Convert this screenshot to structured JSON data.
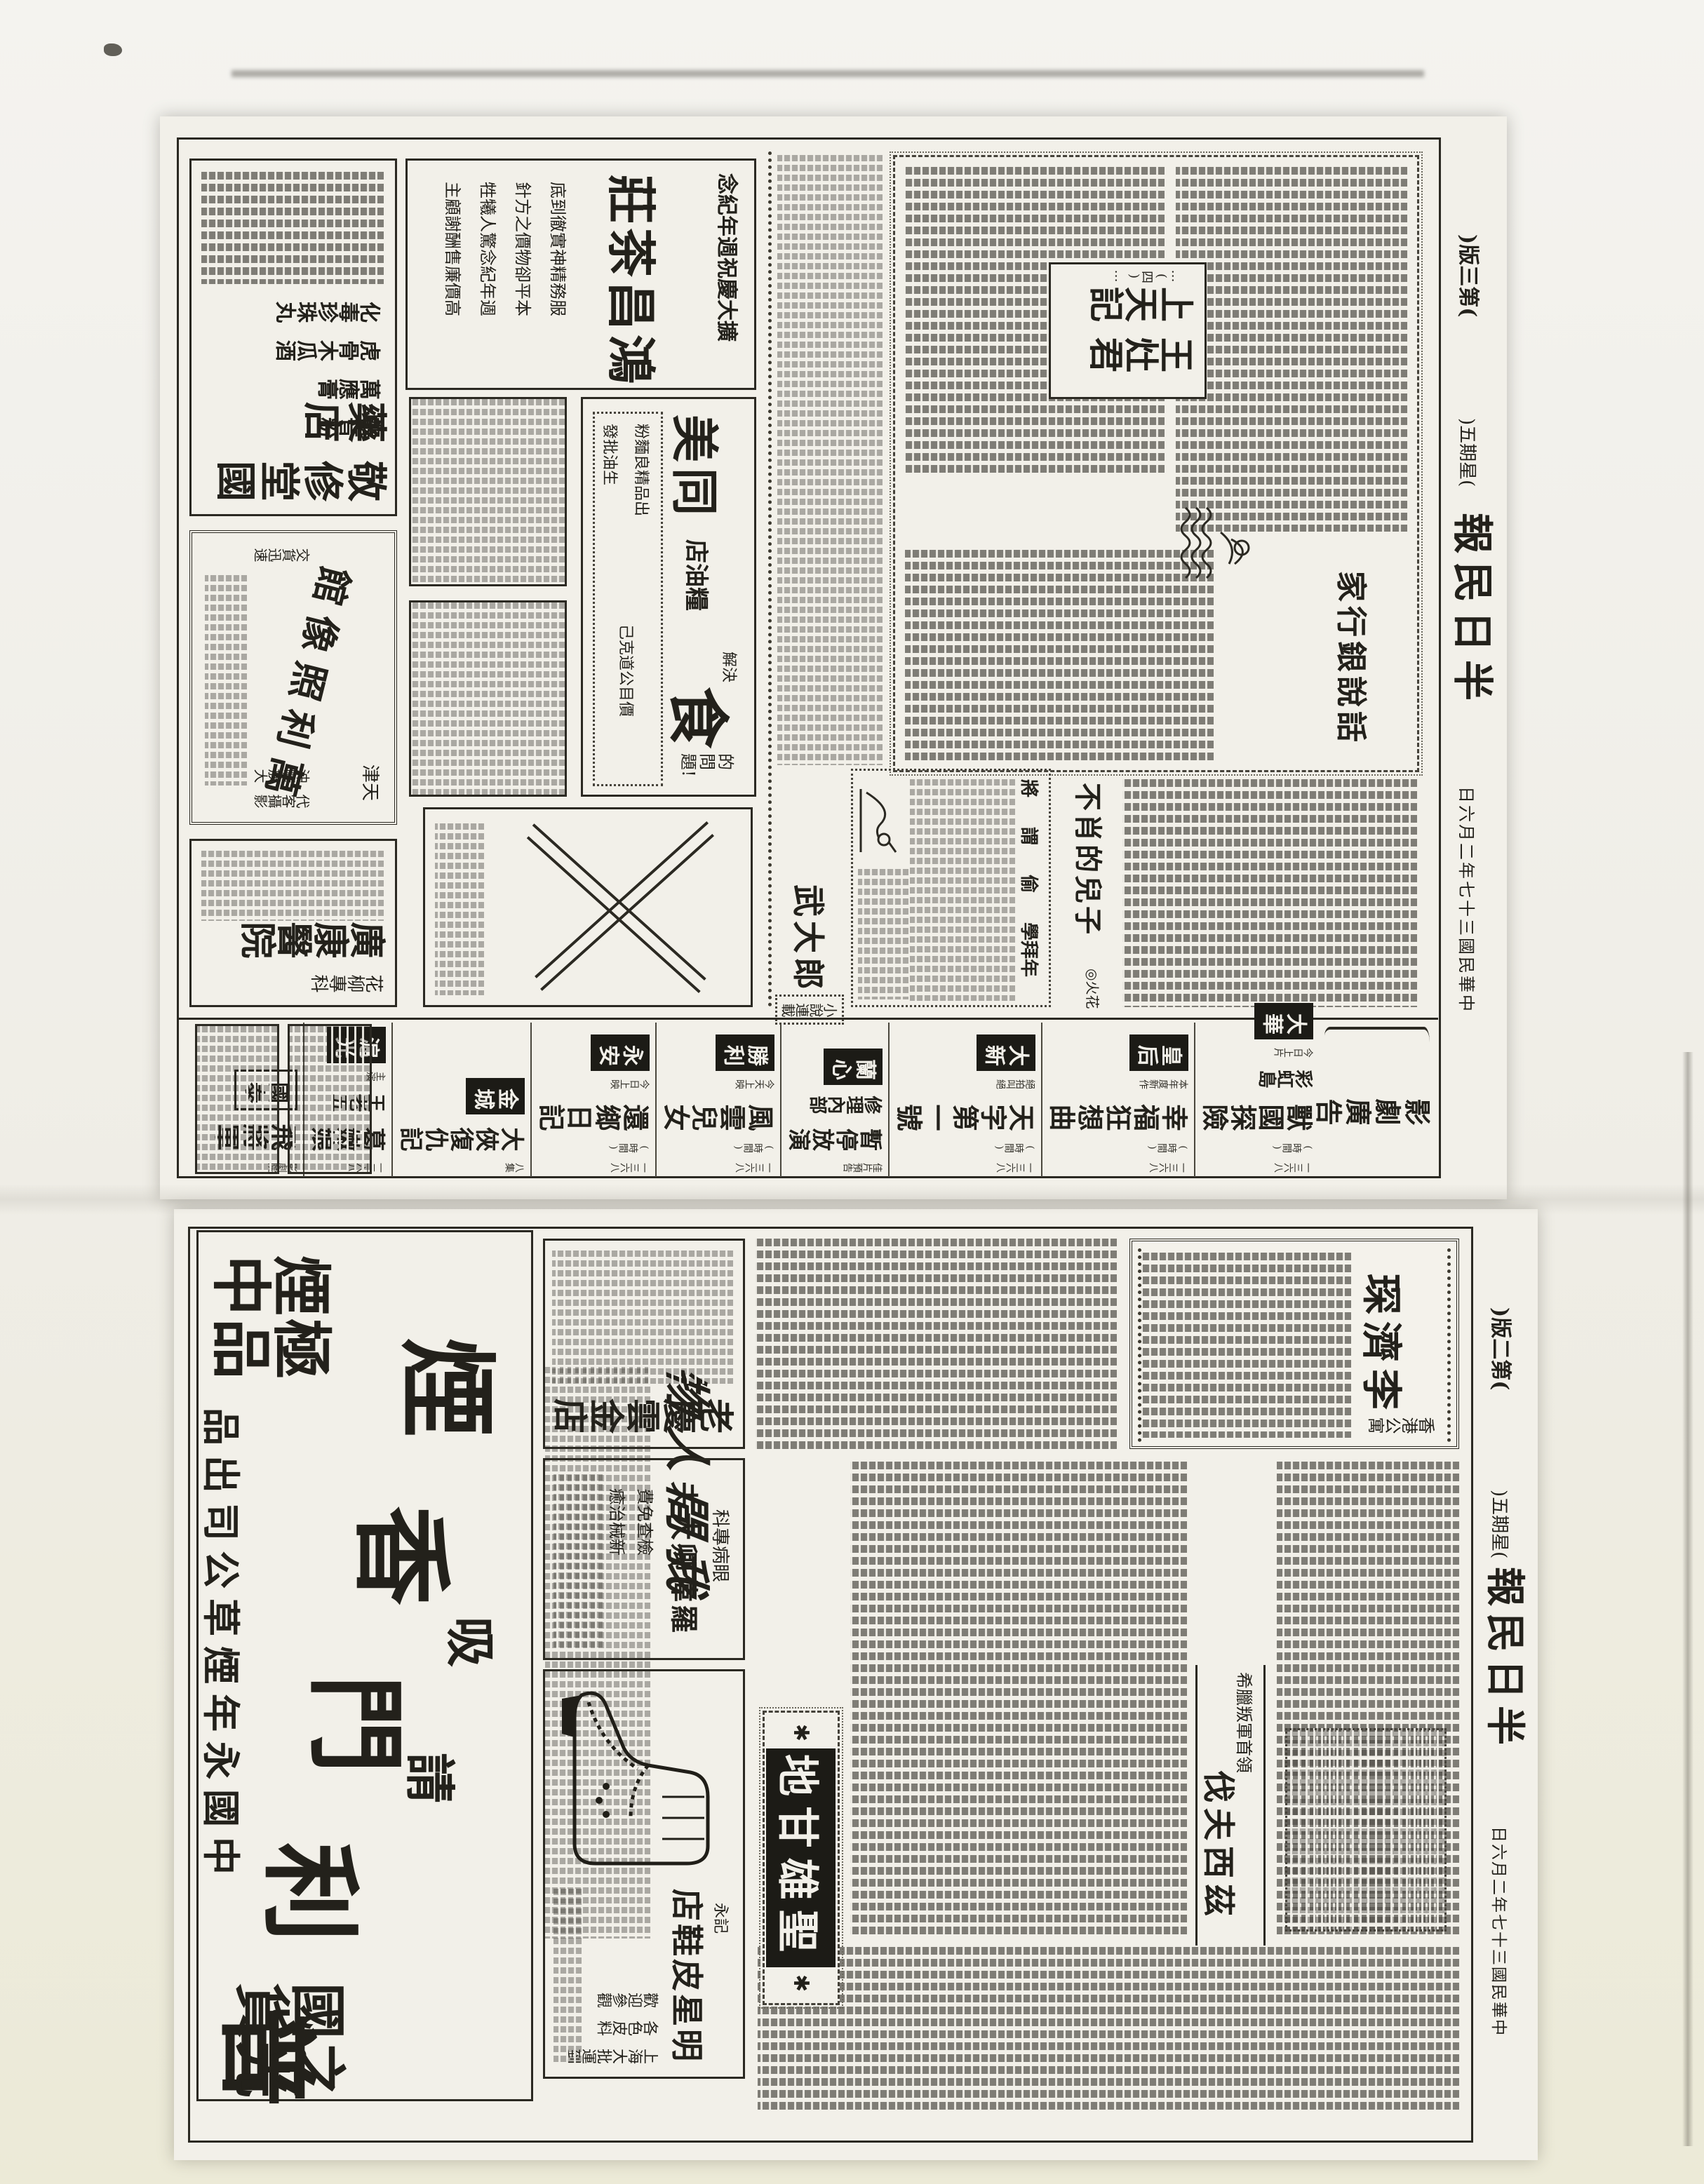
{
  "paper": {
    "masthead": "半日民報",
    "date_line": "中華民國三十七年二月六日",
    "weekday": "(星期五)",
    "ink_color": "#23211b",
    "paper_color": "#f2f0e9"
  },
  "page3": {
    "page_label": "(第三版)",
    "supplement": {
      "feature_headline": "話說銀行家",
      "serial_col_right": "王灶君",
      "serial_col_left": "上天記",
      "serial_note": "…(四)…",
      "essay_title": "不肖的兒子",
      "essay_author": "◎火花",
      "novel_title": "武大郎",
      "novel_label": "小說連載",
      "catchwords": [
        "將",
        "謂",
        "偷",
        "學拜年"
      ]
    },
    "ads": {
      "pharmacy": {
        "name": "敬修堂國藥店",
        "products": [
          "觀音粉",
          "萬應膏",
          "虎骨木瓜酒",
          "化毒珍珠丸"
        ]
      },
      "photo_studio": {
        "city": "天津",
        "name": "萬利照像館",
        "services": [
          "代客攝影",
          "沖曬放大",
          "交貨迅速"
        ]
      },
      "hospital": {
        "dept": "花柳專科",
        "name": "廣康醫院"
      },
      "tea_house": {
        "banner": "擴大慶祝週年紀念",
        "name": "鴻昌茶莊",
        "slogans": [
          "服務精神實徹到底",
          "本平卻物價之方針",
          "週年紀念驚人犧牲",
          "高價廉售酬謝顧主"
        ]
      },
      "grain_oil": {
        "name": "同美",
        "type": "糧油店",
        "hook_small": "解決",
        "hook_big": "食",
        "hook_tail": "的問題!",
        "items": [
          "出品精良麵粉",
          "生油批發",
          "價目公道克己"
        ]
      }
    },
    "cinema": {
      "header": "影劇廣告",
      "time_label": "(時間)",
      "listings": [
        {
          "theater": "大華",
          "film": "獸國探險",
          "film2": "彩虹島",
          "tag": "今日上片",
          "phone": "一三六八"
        },
        {
          "theater": "皇后",
          "film": "幸福狂想曲",
          "film2": "",
          "tag": "本年度新作",
          "phone": "一三六八"
        },
        {
          "theater": "大新",
          "film": "天字第一號",
          "film2": "",
          "tag": "絕拍叫絕",
          "phone": "一三六八"
        },
        {
          "theater": "蘭心",
          "film": "暫停放演",
          "film2": "修理內部",
          "tag": "佳片預告",
          "phone": ""
        },
        {
          "theater": "勝利",
          "film": "風雲兒女",
          "film2": "",
          "tag": "今天上映",
          "phone": "一三六八"
        },
        {
          "theater": "永安",
          "film": "還鄉日記",
          "film2": "",
          "tag": "今日上映",
          "phone": "一三六八"
        },
        {
          "theater": "金城",
          "film": "大俠復仇記",
          "film2": "",
          "tag": "八集",
          "phone": ""
        },
        {
          "theater": "滬光",
          "film": "葛嫩娘",
          "film2": "王老五",
          "tag": "主演",
          "phone": "一三六八"
        },
        {
          "theater": "國泰",
          "film": "飛將軍",
          "film2": "",
          "tag": "影劇院",
          "phone": ""
        }
      ]
    }
  },
  "page2": {
    "page_label": "(第二版)",
    "lead": {
      "kicker": "香港公寓",
      "name": "李濟琛"
    },
    "greek": {
      "kicker": "希臘叛軍首領",
      "name": "伐夫西茲"
    },
    "gandhi": "聖雄甘地",
    "calligraphy": "物人間我",
    "ads": {
      "gold_shop": {
        "name": "老慶雲金店"
      },
      "eye_clinic": {
        "dept": "眼病專科",
        "name": "羅偉卿大夫",
        "lines": [
          "檢查免費",
          "新械治癒"
        ]
      },
      "shoe_store": {
        "name": "明星皮鞋店",
        "sub": "永記",
        "lines": [
          "上海大批運到",
          "各色皮料",
          "歡迎參觀"
        ]
      },
      "cigarette": {
        "cmd_a": "請",
        "cmd_b": "吸",
        "brand": "普利門香烟",
        "brand_chars": [
          "煙",
          "香",
          "門",
          "利",
          "普"
        ],
        "grade": "煙中極品",
        "slogan": "國貨之光",
        "maker": "中國永年煙草公司出品"
      }
    }
  }
}
